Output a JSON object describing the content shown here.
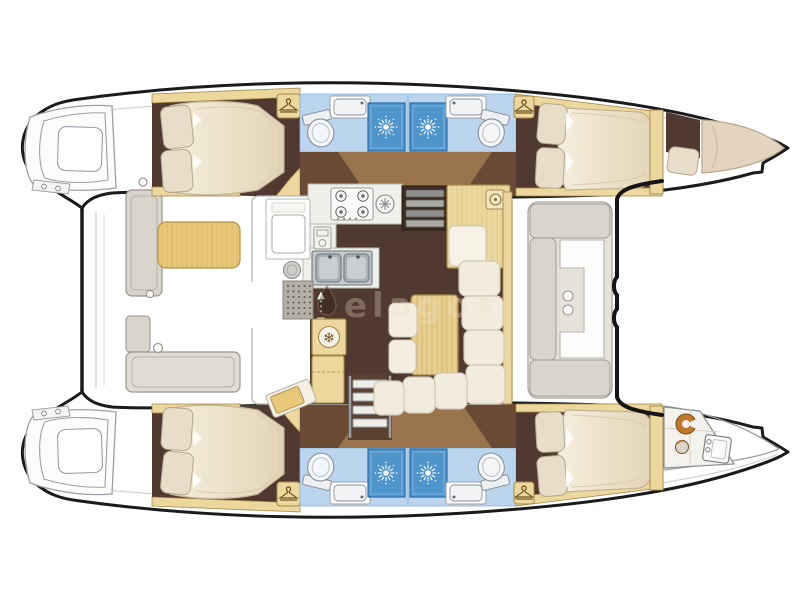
{
  "diagram": {
    "type": "boat-floorplan",
    "subject": "catamaran sailing yacht deck & accommodation layout, 4 cabins + 4 heads, bow to the right"
  },
  "watermark": {
    "text": "elagos",
    "logo": "droplet-icon"
  },
  "palette": {
    "hull_outline": "#1b1b1b",
    "lineart_grey": "#9aa0a6",
    "floor_brown": "#4f3930",
    "landing_tan": "#a07a50",
    "wood_beige": "#ecd79c",
    "wood_border": "#a5894a",
    "mattress_cream": "#f0e8d5",
    "pillow_cream": "#e7ddc8",
    "bath_light_blue": "#bad5ed",
    "shower_blue": "#4e95cc",
    "cockpit_greige": "#d9d4cc",
    "cushion_tan": "#e9c87a",
    "steel_grey": "#b9bec3",
    "crew_orange": "#c0762c"
  },
  "icons": {
    "fridge_glyph": "❄",
    "companionway_up_glyph": "▲",
    "companionway_down_glyph": "▼",
    "shower_icon": "sunburst",
    "wardrobe_icon": "clothes-hanger",
    "stove_icon": "four-burner-hob",
    "sink_icon": "double-basin",
    "toilet_icon": "toilet-bowl",
    "nav_seat_icon": "round-stool"
  }
}
